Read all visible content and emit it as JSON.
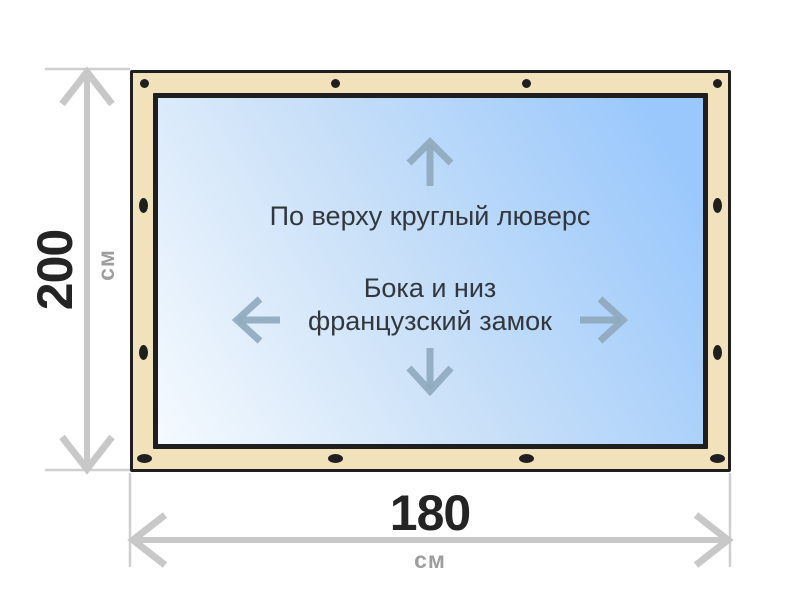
{
  "diagram": {
    "height_dimension": {
      "value": "200",
      "unit": "см"
    },
    "width_dimension": {
      "value": "180",
      "unit": "см"
    },
    "labels": {
      "top_edge": "По верху круглый люверс",
      "sides_line1": "Бока и низ",
      "sides_line2": "французский замок"
    },
    "grommets": {
      "top": 4,
      "bottom": 4,
      "left": 2,
      "right": 2
    },
    "colors": {
      "frame": "#f2e2bb",
      "outline": "#1f1f1f",
      "glass_light": "#f5fafe",
      "glass_blue": "#9ac8fc",
      "inner_arrow": "#8fa9be",
      "dimension_line": "#c8c8c8",
      "extension_line": "#cfcfcf",
      "dimension_number": "#242424",
      "unit_text": "#9e9e9e",
      "annotation_text": "#32373d"
    }
  }
}
